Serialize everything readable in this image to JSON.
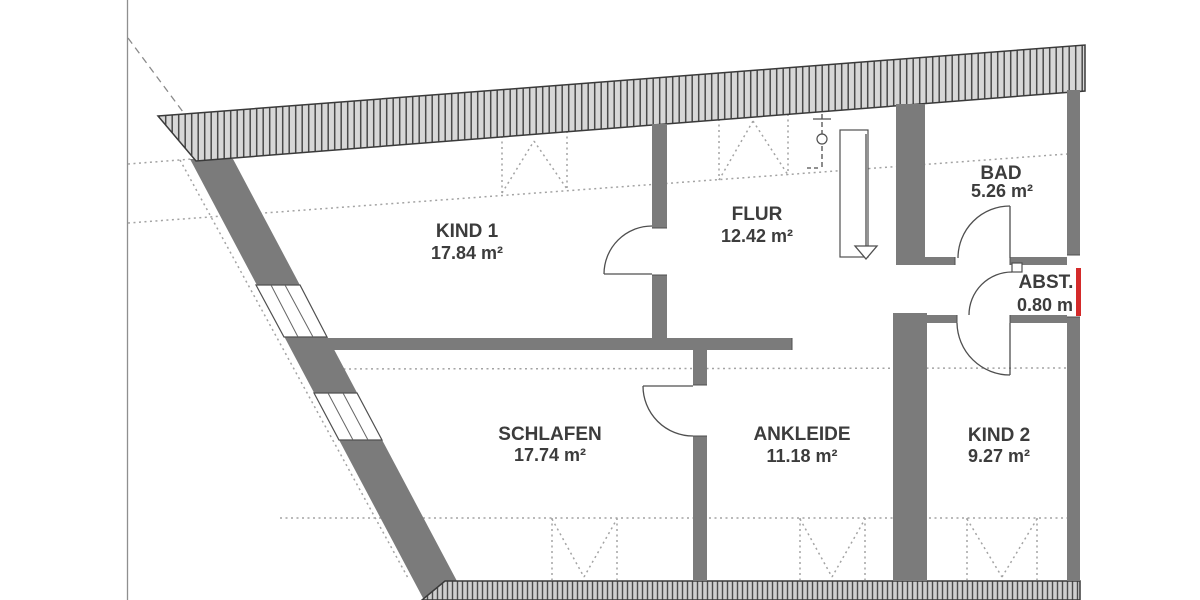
{
  "plan": {
    "type": "floor-plan",
    "floor": "attic storey (sloped roof walls shown hatched)",
    "rooms": [
      {
        "name": "KIND 1",
        "area": "17.84 m²"
      },
      {
        "name": "FLUR",
        "area": "12.42 m²"
      },
      {
        "name": "BAD",
        "area": "5.26 m²"
      },
      {
        "name": "ABST.",
        "area": "0.80 m"
      },
      {
        "name": "SCHLAFEN",
        "area": "17.74 m²"
      },
      {
        "name": "ANKLEIDE",
        "area": "11.18 m²"
      },
      {
        "name": "KIND 2",
        "area": "9.27 m²"
      }
    ],
    "colors": {
      "wall_gray": "#7b7b7b",
      "hatch_fill": "#d7d7d7",
      "hatch_stroke": "#494949",
      "line_dark": "#4f4f4f",
      "dotted_gray": "#a3a3a3",
      "text_gray": "#3c3c3c",
      "highlight_red": "#d42a2a",
      "background": "#ffffff"
    }
  }
}
